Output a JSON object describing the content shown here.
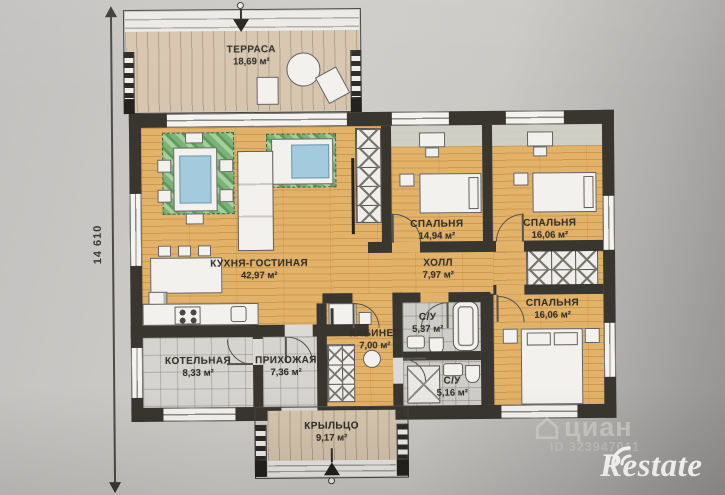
{
  "title": "house-floor-plan-photo",
  "rooms": {
    "terrace": {
      "name": "ТЕРРАСА",
      "area": "18,69 м²"
    },
    "kitchen_living": {
      "name": "КУХНЯ-ГОСТИНАЯ",
      "area": "42,97 м²"
    },
    "bedroom_1": {
      "name": "СПАЛЬНЯ",
      "area": "14,94 м²"
    },
    "bedroom_2": {
      "name": "СПАЛЬНЯ",
      "area": "16,06 м²"
    },
    "hall": {
      "name": "ХОЛЛ",
      "area": "7,97 м²"
    },
    "bedroom_3": {
      "name": "СПАЛЬНЯ",
      "area": "16,06 м²"
    },
    "office": {
      "name": "КАБИНЕТ",
      "area": "7,00 м²"
    },
    "bathroom_1": {
      "name": "С/У",
      "area": "5,37 м²"
    },
    "bathroom_2": {
      "name": "С/У",
      "area": "5,16 м²"
    },
    "boiler": {
      "name": "КОТЕЛЬНАЯ",
      "area": "8,33 м²"
    },
    "entry_hall": {
      "name": "ПРИХОЖАЯ",
      "area": "7,36 м²"
    },
    "porch": {
      "name": "КРЫЛЬЦО",
      "area": "9,17 м²"
    }
  },
  "dimensions": {
    "left_vertical": "14 610"
  },
  "watermarks": {
    "cian_brand": "циан",
    "cian_id": "ID 323947011",
    "agency_logo": "Restate"
  },
  "colors": {
    "wood_floor": "#e3b269",
    "deck_wood": "#d7c6af",
    "wall": "#38362f",
    "tile": "#d6d4d0",
    "rug_green": "#7ab377",
    "glass_blue": "#a3cbdd",
    "paper": "#cfcdca",
    "logo_white": "#ffffff"
  }
}
